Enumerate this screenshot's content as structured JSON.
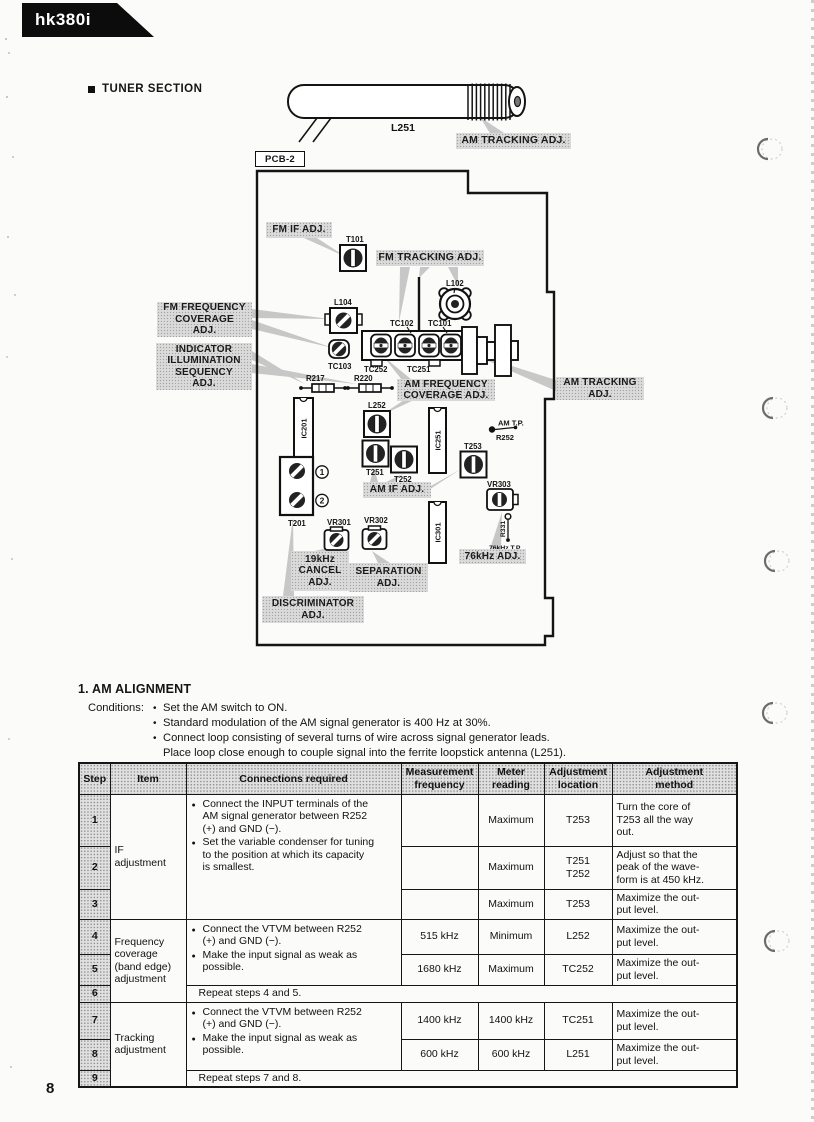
{
  "page": {
    "model": "hk380i",
    "section_title": "TUNER SECTION",
    "page_number": "8"
  },
  "glyphs": {
    "cond_bullet": "•",
    "table_bullet": "●"
  },
  "antenna": {
    "part": "L251",
    "tracking_label": "AM TRACKING ADJ."
  },
  "diagram": {
    "board_label": "PCB-2",
    "adjust_labels": {
      "fm_if": "FM IF ADJ.",
      "fm_tracking": "FM TRACKING ADJ.",
      "fm_frequency_coverage": "FM FREQUENCY\nCOVERAGE\nADJ.",
      "indicator_illumination": "INDICATOR\nILLUMINATION\nSEQUENCY\nADJ.",
      "am_frequency_coverage": "AM FREQUENCY\nCOVERAGE ADJ.",
      "am_tracking": "AM TRACKING\nADJ.",
      "am_if": "AM IF ADJ.",
      "cancel_19khz": "19kHz\nCANCEL\nADJ.",
      "separation": "SEPARATION\nADJ.",
      "discriminator": "DISCRIMINATOR\nADJ.",
      "adj_76khz": "76kHz ADJ."
    },
    "components": {
      "t101": "T101",
      "l102": "L102",
      "l104": "L104",
      "tc103": "TC103",
      "tc102": "TC102",
      "tc101": "TC101",
      "tc252": "TC252",
      "tc251": "TC251",
      "r217": "R217",
      "r220": "R220",
      "ic201": "IC201",
      "ic251": "IC251",
      "ic301": "IC301",
      "l252": "L252",
      "t251": "T251",
      "t252": "T252",
      "t253": "T253",
      "t201": "T201",
      "vr301": "VR301",
      "vr302": "VR302",
      "vr303": "VR303",
      "am_tp": "AM T.P.",
      "r252": "R252",
      "r331": "R331",
      "tp_76khz": "76kHz T.P.",
      "point1": "1",
      "point2": "2"
    }
  },
  "alignment": {
    "heading": "1. AM ALIGNMENT",
    "conditions_label": "Conditions:",
    "conditions": [
      "Set the AM switch to ON.",
      "Standard modulation of the AM signal generator is 400 Hz at 30%.",
      "Connect loop consisting of several turns of wire across signal generator leads.\nPlace loop close enough to couple signal into the ferrite loopstick antenna (L251)."
    ],
    "table": {
      "headers": [
        "Step",
        "Item",
        "Connections required",
        "Measurement\nfrequency",
        "Meter\nreading",
        "Adjustment\nlocation",
        "Adjustment\nmethod"
      ],
      "items": [
        "IF\nadjustment",
        "Frequency\ncoverage\n(band edge)\nadjustment",
        "Tracking\nadjustment"
      ],
      "connections": [
        [
          "Connect the INPUT terminals of the\nAM signal generator between R252\n(+) and GND (−).",
          "Set the variable condenser for tuning\nto the position at which its capacity\nis smallest."
        ],
        [
          "Connect the VTVM between R252\n(+) and GND (−).",
          "Make the input signal as weak as\npossible."
        ],
        [
          "Connect the VTVM between R252\n(+) and GND (−).",
          "Make the input signal as weak as\npossible."
        ]
      ],
      "rows": [
        {
          "step": "1",
          "freq": "",
          "meter": "Maximum",
          "location": "T253",
          "method": "Turn the core of\nT253 all the way\nout."
        },
        {
          "step": "2",
          "freq": "",
          "meter": "Maximum",
          "location": "T251\nT252",
          "method": "Adjust so that the\npeak of the wave-\nform is at 450 kHz."
        },
        {
          "step": "3",
          "freq": "",
          "meter": "Maximum",
          "location": "T253",
          "method": "Maximize the out-\nput level."
        },
        {
          "step": "4",
          "freq": "515 kHz",
          "meter": "Minimum",
          "location": "L252",
          "method": "Maximize the out-\nput level."
        },
        {
          "step": "5",
          "freq": "1680 kHz",
          "meter": "Maximum",
          "location": "TC252",
          "method": "Maximize the out-\nput level."
        },
        {
          "step": "6",
          "repeat": "Repeat steps 4 and 5."
        },
        {
          "step": "7",
          "freq": "1400 kHz",
          "meter": "1400 kHz",
          "location": "TC251",
          "method": "Maximize the out-\nput level."
        },
        {
          "step": "8",
          "freq": "600 kHz",
          "meter": "600 kHz",
          "location": "L251",
          "method": "Maximize the out-\nput level."
        },
        {
          "step": "9",
          "repeat": "Repeat steps 7 and 8."
        }
      ]
    }
  }
}
